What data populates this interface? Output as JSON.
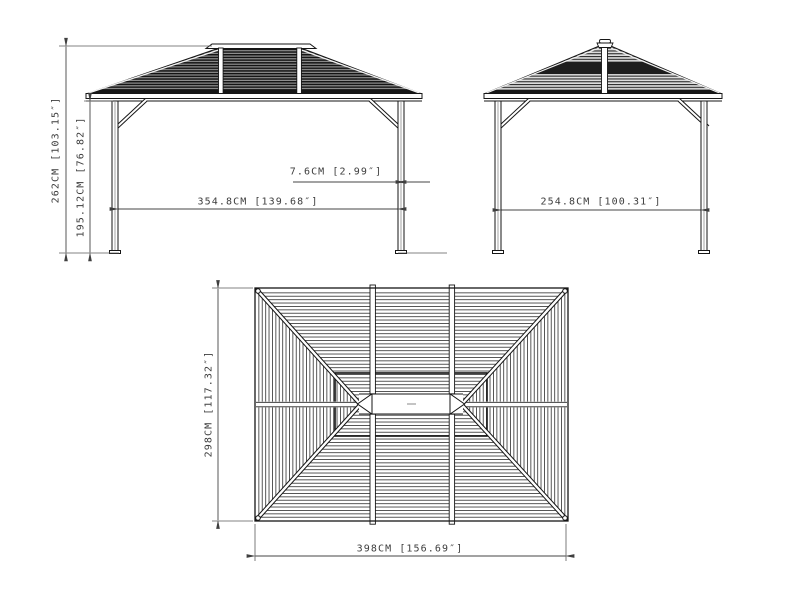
{
  "front_view": {
    "total_height": "262CM [103.15″]",
    "post_height": "195.12CM [76.82″]",
    "inner_width": "354.8CM [139.68″]",
    "post_width": "7.6CM [2.99″]"
  },
  "side_view": {
    "inner_width": "254.8CM [100.31″]"
  },
  "top_view": {
    "depth": "298CM [117.32″]",
    "width": "398CM [156.69″]"
  },
  "colors": {
    "background": "#ffffff",
    "line": "#161616",
    "dimension": "#3d3d3d",
    "roof_dark_stripe": "#141414",
    "roof_gray": "#919191",
    "roof_light": "#dcdcdc"
  }
}
